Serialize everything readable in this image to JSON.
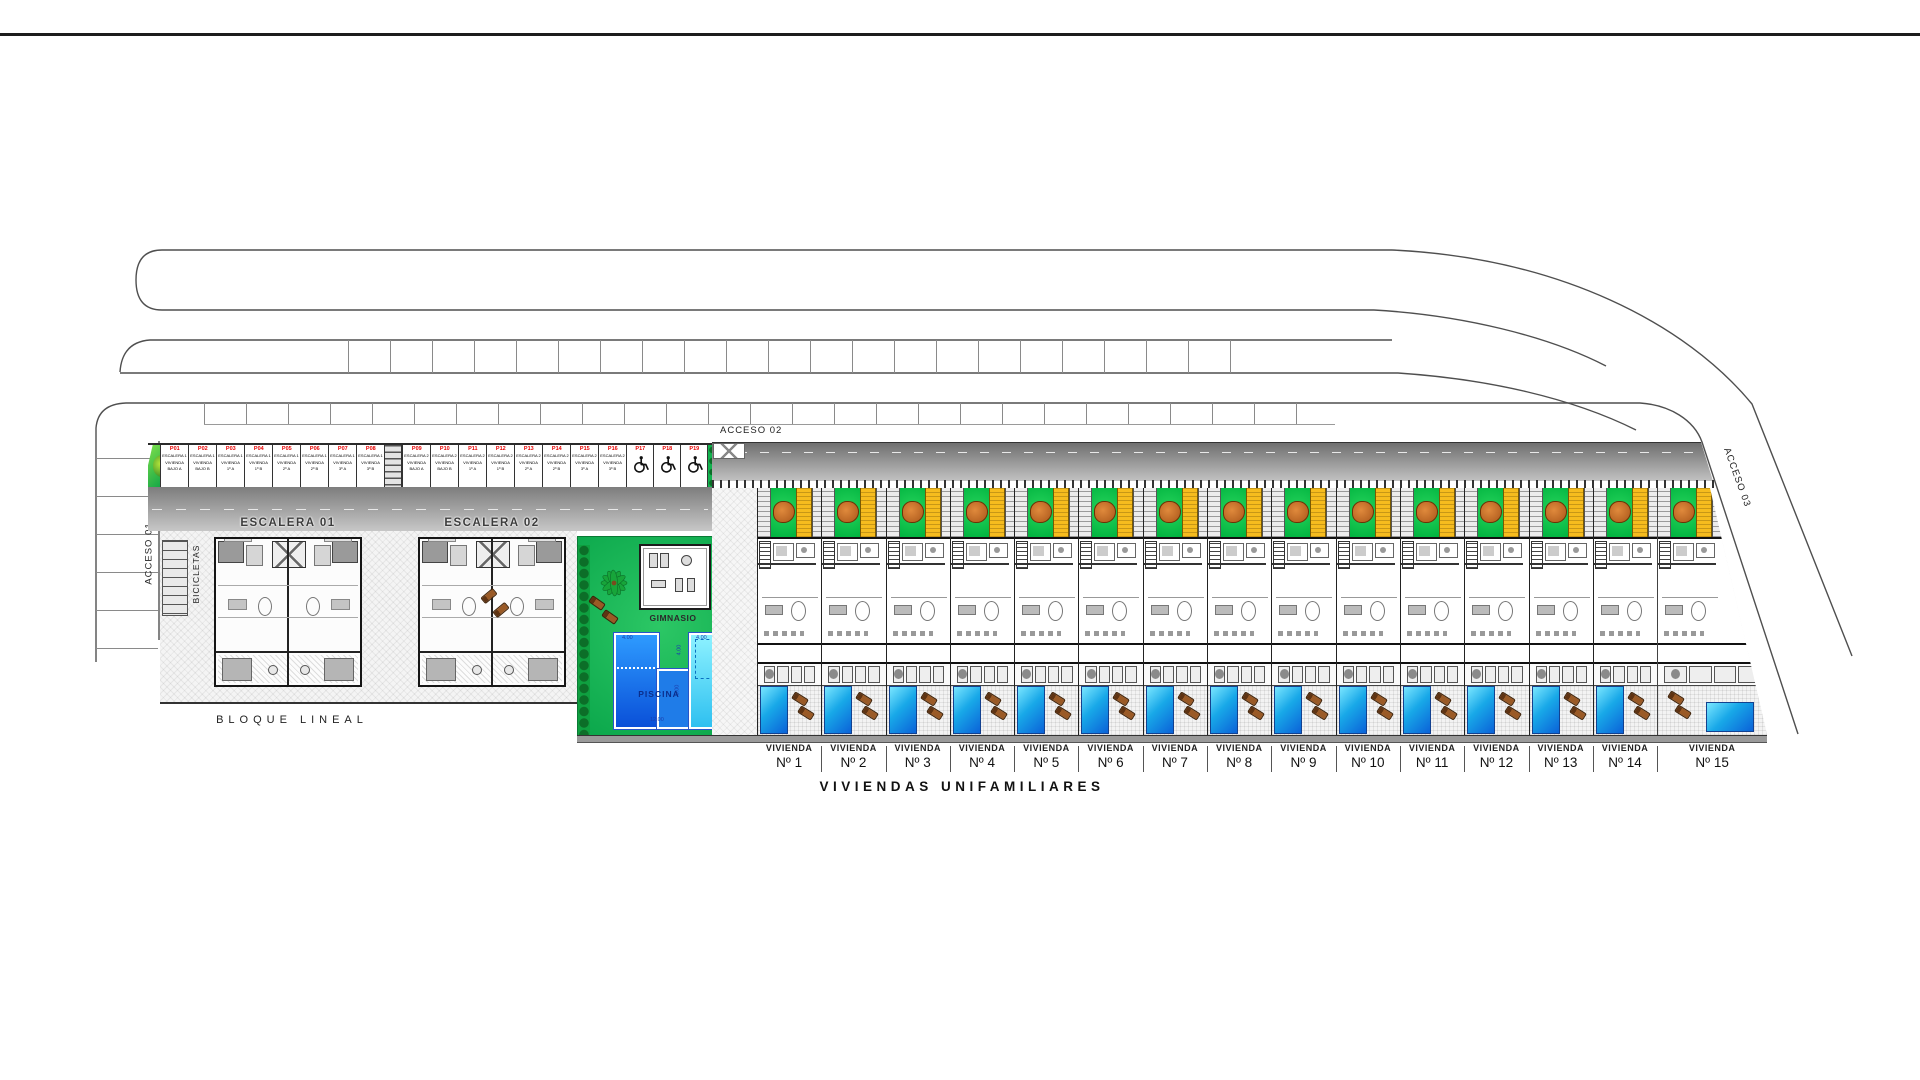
{
  "roads": {
    "acceso_01_label": "ACCESO 01",
    "acceso_02_label": "ACCESO 02",
    "acceso_03_label": "ACCESO 03"
  },
  "parking": {
    "stalls": [
      {
        "id": "P01",
        "lines": [
          "ESCALERA 1",
          "VIVIENDA",
          "BAJO A"
        ]
      },
      {
        "id": "P02",
        "lines": [
          "ESCALERA 1",
          "VIVIENDA",
          "BAJO B"
        ]
      },
      {
        "id": "P03",
        "lines": [
          "ESCALERA 1",
          "VIVIENDA",
          "1º A"
        ]
      },
      {
        "id": "P04",
        "lines": [
          "ESCALERA 1",
          "VIVIENDA",
          "1º B"
        ]
      },
      {
        "id": "P05",
        "lines": [
          "ESCALERA 1",
          "VIVIENDA",
          "2º A"
        ]
      },
      {
        "id": "P06",
        "lines": [
          "ESCALERA 1",
          "VIVIENDA",
          "2º B"
        ]
      },
      {
        "id": "P07",
        "lines": [
          "ESCALERA 1",
          "VIVIENDA",
          "3º A"
        ]
      },
      {
        "id": "P08",
        "lines": [
          "ESCALERA 1",
          "VIVIENDA",
          "3º B"
        ]
      },
      {
        "id": "P09",
        "lines": [
          "ESCALERA 2",
          "VIVIENDA",
          "BAJO A"
        ]
      },
      {
        "id": "P10",
        "lines": [
          "ESCALERA 2",
          "VIVIENDA",
          "BAJO B"
        ]
      },
      {
        "id": "P11",
        "lines": [
          "ESCALERA 2",
          "VIVIENDA",
          "1º A"
        ]
      },
      {
        "id": "P12",
        "lines": [
          "ESCALERA 2",
          "VIVIENDA",
          "1º B"
        ]
      },
      {
        "id": "P13",
        "lines": [
          "ESCALERA 2",
          "VIVIENDA",
          "2º A"
        ]
      },
      {
        "id": "P14",
        "lines": [
          "ESCALERA 2",
          "VIVIENDA",
          "2º B"
        ]
      },
      {
        "id": "P15",
        "lines": [
          "ESCALERA 2",
          "VIVIENDA",
          "3º A"
        ]
      },
      {
        "id": "P16",
        "lines": [
          "ESCALERA 2",
          "VIVIENDA",
          "3º B"
        ]
      },
      {
        "id": "P17",
        "icon": "wheelchair"
      },
      {
        "id": "P18",
        "icon": "wheelchair"
      },
      {
        "id": "P19",
        "icon": "wheelchair"
      }
    ]
  },
  "bloque_lineal": {
    "title": "BLOQUE LINEAL",
    "bicycle_label": "BICICLETAS",
    "buildings": [
      {
        "name": "ESCALERA 01",
        "unit_left": "Vivienda B",
        "unit_right": "Vivienda A"
      },
      {
        "name": "ESCALERA 02",
        "unit_left": "Vivienda B",
        "unit_right": "Vivienda A"
      }
    ]
  },
  "amenities": {
    "gym_label": "GIMNASIO",
    "pool": {
      "label": "PISCINA",
      "dimensions": [
        {
          "value": "4.00",
          "pos": "top-left"
        },
        {
          "value": "4.00",
          "pos": "top-right"
        },
        {
          "value": "4.00",
          "pos": "notch-vertical"
        },
        {
          "value": "10.00",
          "pos": "right-vertical"
        },
        {
          "value": "8.00",
          "pos": "mid-vertical"
        },
        {
          "value": "12.00",
          "pos": "bottom"
        }
      ]
    }
  },
  "villas": {
    "section_title": "VIVIENDAS UNIFAMILIARES",
    "label_word": "VIVIENDA",
    "units": [
      "Nº 1",
      "Nº 2",
      "Nº 3",
      "Nº 4",
      "Nº 5",
      "Nº 6",
      "Nº 7",
      "Nº 8",
      "Nº 9",
      "Nº 10",
      "Nº 11",
      "Nº 12",
      "Nº 13",
      "Nº 14",
      "Nº 15"
    ]
  },
  "colors": {
    "stall_id_red": "#e60000",
    "lawn_green": "#0db14b",
    "plot_green": "#00c44a",
    "pergola_yellow": "#f6bc1e",
    "pool_deep_blue": "#0b62d8",
    "pool_light_blue": "#7ae6ff",
    "tree_orange": "#c76f28",
    "road_gray": "#8c8c8c"
  }
}
